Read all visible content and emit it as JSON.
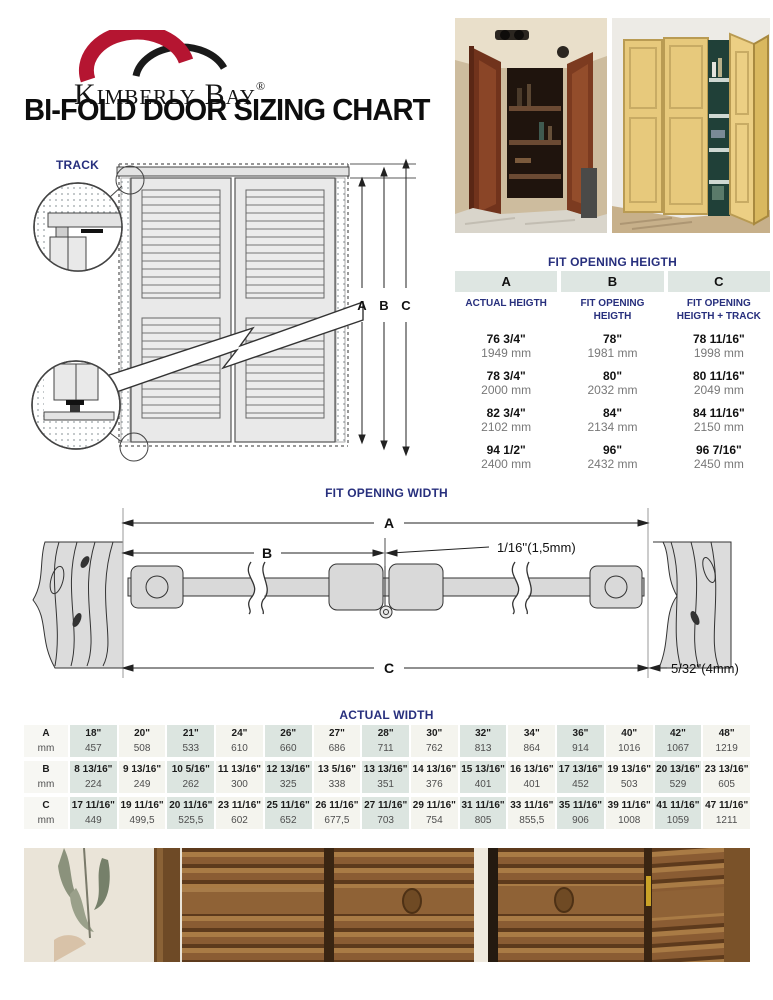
{
  "brand": {
    "name": "Kimberly Bay",
    "registered": "®"
  },
  "page_title": "BI-FOLD DOOR SIZING CHART",
  "door_diagram": {
    "track_label": "TRACK",
    "dim_a": "A",
    "dim_b": "B",
    "dim_c": "C"
  },
  "height_table": {
    "title": "FIT OPENING HEIGTH",
    "columns": [
      {
        "letter": "A",
        "subtitle": "ACTUAL HEIGTH"
      },
      {
        "letter": "B",
        "subtitle": "FIT OPENING HEIGTH"
      },
      {
        "letter": "C",
        "subtitle": "FIT OPENING HEIGTH + TRACK"
      }
    ],
    "rows": [
      {
        "cells": [
          {
            "in": "76 3/4\"",
            "mm": "1949 mm"
          },
          {
            "in": "78\"",
            "mm": "1981 mm"
          },
          {
            "in": "78 11/16\"",
            "mm": "1998 mm"
          }
        ]
      },
      {
        "cells": [
          {
            "in": "78 3/4\"",
            "mm": "2000 mm"
          },
          {
            "in": "80\"",
            "mm": "2032 mm"
          },
          {
            "in": "80 11/16\"",
            "mm": "2049 mm"
          }
        ]
      },
      {
        "cells": [
          {
            "in": "82 3/4\"",
            "mm": "2102 mm"
          },
          {
            "in": "84\"",
            "mm": "2134 mm"
          },
          {
            "in": "84 11/16\"",
            "mm": "2150 mm"
          }
        ]
      },
      {
        "cells": [
          {
            "in": "94 1/2\"",
            "mm": "2400 mm"
          },
          {
            "in": "96\"",
            "mm": "2432 mm"
          },
          {
            "in": "96 7/16\"",
            "mm": "2450 mm"
          }
        ]
      }
    ]
  },
  "width_diagram": {
    "title": "FIT OPENING WIDTH",
    "dim_a": "A",
    "dim_b": "B",
    "dim_c": "C",
    "gap_label": "1/16''(1,5mm)",
    "track_offset_label": "5/32''(4mm)"
  },
  "width_table": {
    "title": "ACTUAL WIDTH",
    "row_labels": [
      {
        "letter": "A",
        "unit": "mm"
      },
      {
        "letter": "B",
        "unit": "mm"
      },
      {
        "letter": "C",
        "unit": "mm"
      }
    ],
    "rows": [
      {
        "inches": [
          "18\"",
          "20\"",
          "21\"",
          "24\"",
          "26\"",
          "27\"",
          "28\"",
          "30\"",
          "32\"",
          "34\"",
          "36\"",
          "40\"",
          "42\"",
          "48\""
        ],
        "mm": [
          "457",
          "508",
          "533",
          "610",
          "660",
          "686",
          "711",
          "762",
          "813",
          "864",
          "914",
          "1016",
          "1067",
          "1219"
        ]
      },
      {
        "inches": [
          "8 13/16\"",
          "9 13/16\"",
          "10 5/16\"",
          "11 13/16\"",
          "12 13/16\"",
          "13 5/16\"",
          "13 13/16\"",
          "14 13/16\"",
          "15 13/16\"",
          "16 13/16\"",
          "17 13/16\"",
          "19 13/16\"",
          "20 13/16\"",
          "23 13/16\""
        ],
        "mm": [
          "224",
          "249",
          "262",
          "300",
          "325",
          "338",
          "351",
          "376",
          "401",
          "401",
          "452",
          "503",
          "529",
          "605"
        ]
      },
      {
        "inches": [
          "17 11/16\"",
          "19 11/16\"",
          "20 11/16\"",
          "23 11/16\"",
          "25 11/16\"",
          "26 11/16\"",
          "27 11/16\"",
          "29 11/16\"",
          "31 11/16\"",
          "33 11/16\"",
          "35 11/16\"",
          "39 11/16\"",
          "41 11/16\"",
          "47 11/16\""
        ],
        "mm": [
          "449",
          "499,5",
          "525,5",
          "602",
          "652",
          "677,5",
          "703",
          "754",
          "805",
          "855,5",
          "906",
          "1008",
          "1059",
          "1211"
        ]
      }
    ]
  },
  "colors": {
    "navy": "#272f7d",
    "brand_red": "#b51531",
    "table_header_bg": "#dee6e2",
    "cell_shaded": "#dce5e0",
    "cell_plain": "#f4f4ee"
  }
}
